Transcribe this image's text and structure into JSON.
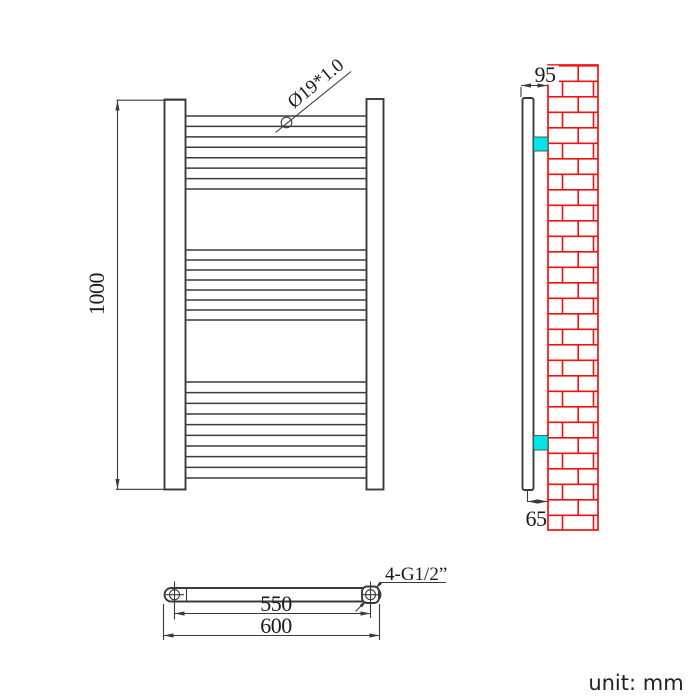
{
  "drawing": {
    "unit_note": "unit: mm",
    "front_view": {
      "height_dim": "1000",
      "tube_callout": "Ø19*1.0",
      "rung_groups": [
        {
          "count": 8,
          "y_start": 116,
          "y_end": 189
        },
        {
          "count": 8,
          "y_start": 250,
          "y_end": 320
        },
        {
          "count": 10,
          "y_start": 382,
          "y_end": 478
        }
      ]
    },
    "side_view": {
      "wall_offset_top_dim": "95",
      "wall_offset_bottom_dim": "65"
    },
    "bottom_view": {
      "pitch_dim": "550",
      "width_dim": "600",
      "connection_callout": "4-G1/2”"
    },
    "colors": {
      "brick_red": "#f01212",
      "bracket_cyan": "#00e5e5",
      "line_dark": "#3a3a3a"
    }
  }
}
